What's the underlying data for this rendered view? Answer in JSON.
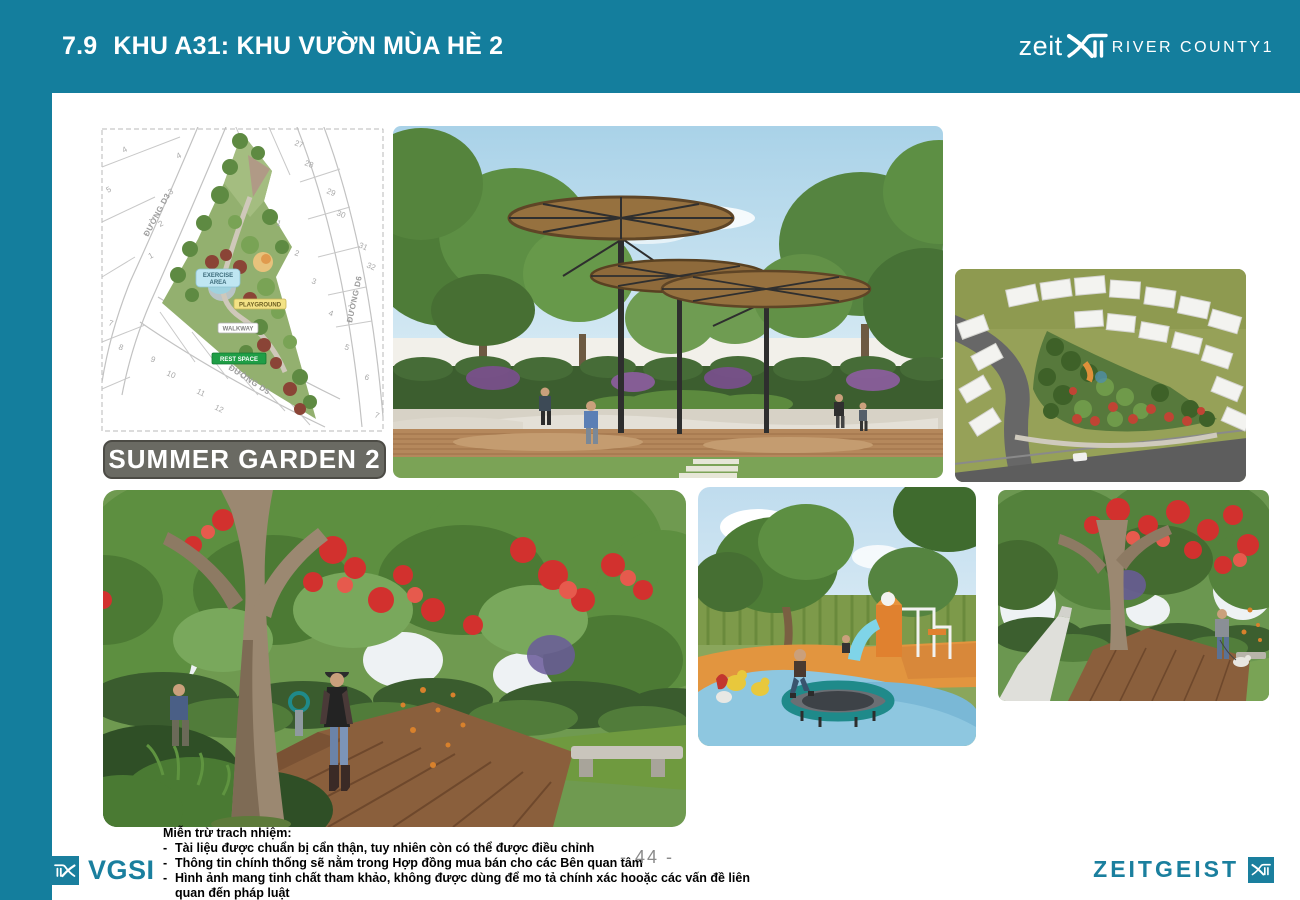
{
  "header": {
    "section_number": "7.9",
    "title": "KHU A31: KHU VƯỜN MÙA HÈ 2",
    "logo_zeit": "zeit",
    "logo_river_county": "RIVER COUNTY1"
  },
  "badge_label": "SUMMER GARDEN 2",
  "site_map": {
    "street_d3": "ĐƯỜNG D3",
    "street_d5": "ĐƯỜNG D5",
    "street_d6": "ĐƯỜNG D6",
    "label_exercise_line1": "EXERCISE",
    "label_exercise_line2": "AREA",
    "label_playground": "PLAYGROUND",
    "label_walkway": "WALKWAY",
    "label_rest_space": "REST SPACE",
    "lots_left_outer": [
      "4",
      "5"
    ],
    "lots_left_inner": [
      "4",
      "3",
      "2",
      "1"
    ],
    "lots_bottom_left": [
      "7",
      "8",
      "9",
      "10",
      "11",
      "12"
    ],
    "lots_right_top": [
      "27",
      "28",
      "29",
      "30",
      "31",
      "32"
    ],
    "lots_right_mid": [
      "1",
      "2"
    ],
    "lots_right_bottom": [
      "3",
      "4",
      "5",
      "6",
      "7"
    ]
  },
  "footer": {
    "disclaimer_title": "Miễn trừ trach nhiệm:",
    "bullet": "-",
    "disclaimer_items": [
      "Tài liệu được chuẩn bị cẩn thận, tuy nhiên còn có thể được điều chỉnh",
      "Thông tin chính thống sẽ nằm trong Hợp đồng mua bán cho các Bên quan tâm",
      "Hình ảnh mang tinh chất tham khảo, không được dùng để mo tả chính xác hooặc các vấn đề liên quan đến pháp luật"
    ],
    "page_number": "- 44 -",
    "vgsi_label": "VGSI",
    "zeitgeist_label": "ZEITGEIST"
  },
  "colors": {
    "teal": "#147e9d",
    "badge_gray": "#6a6a63"
  }
}
